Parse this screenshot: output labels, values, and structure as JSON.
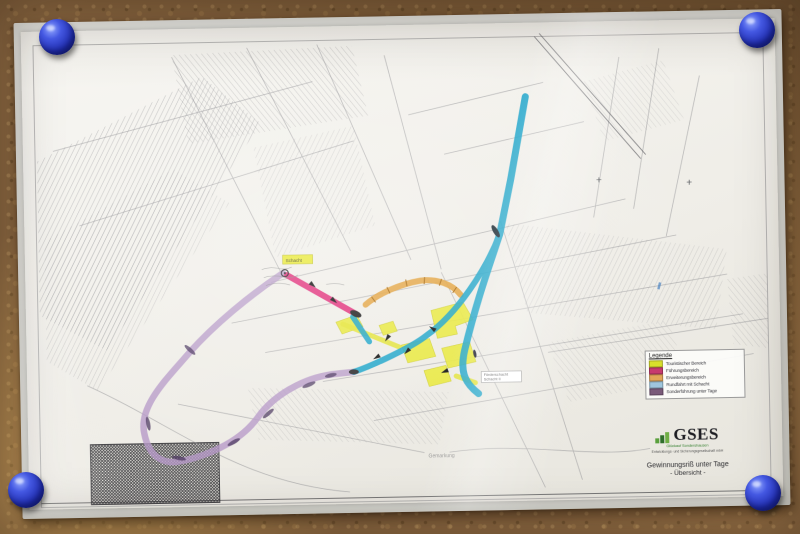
{
  "photo": {
    "surface": "cork-board",
    "pin_color": "#2b3ab5",
    "pin_count": 4
  },
  "map": {
    "legend": {
      "title": "Legende",
      "items": [
        {
          "label": "Touristischer Bereich",
          "color": "#d9df2b"
        },
        {
          "label": "Führungsbereich",
          "color": "#c73a6e"
        },
        {
          "label": "Erweiterungsbereich",
          "color": "#e2a558"
        },
        {
          "label": "Rundfahrt mit Schacht",
          "color": "#9fc6dd"
        },
        {
          "label": "Sonderführung unter Tage",
          "color": "#7a5a7a"
        }
      ]
    },
    "title_block": {
      "logo_text": "GSES",
      "tagline_line1": "Glückauf Sondershausen",
      "tagline_line2": "Entwicklungs- und Sicherungsgesellschaft mbH",
      "map_title": "Gewinnungsriß unter Tage",
      "map_subtitle": "- Übersicht -"
    },
    "labels": {
      "yellow_tag": "Schacht",
      "shaft_box_line1": "Förderschacht",
      "shaft_box_line2": "Schacht II",
      "district_label": "Gemarkung",
      "cross_mark": "+"
    },
    "route_colors": {
      "tour_cyan": "#18a3c9",
      "tour_pink": "#e23a80",
      "tour_orange": "#e2a23c",
      "tour_purple": "#b79ac8",
      "highlight_yellow": "#e9e93c"
    }
  }
}
